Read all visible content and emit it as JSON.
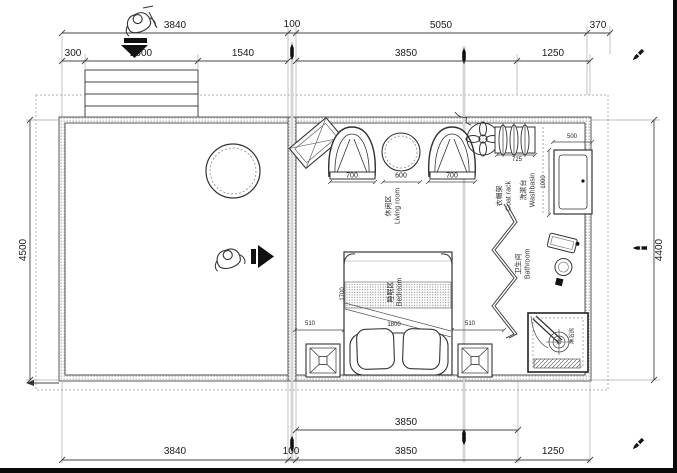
{
  "dims": {
    "top_row1": [
      "3840",
      "100",
      "5050",
      "370"
    ],
    "top_row2": [
      "300",
      "2000",
      "1540",
      "3850",
      "1250"
    ],
    "bottom_row1": [
      "3850"
    ],
    "bottom_row2": [
      "3840",
      "100",
      "3850",
      "1250"
    ],
    "left": "4500",
    "right": "4400",
    "living": [
      "700",
      "600",
      "700"
    ],
    "coat_rack": "725",
    "washbasin": [
      "500",
      "1000"
    ],
    "bed": [
      "510",
      "1800",
      "510",
      "1700"
    ]
  },
  "rooms": {
    "living": {
      "zh": "休闲区",
      "en": "Living room"
    },
    "coat_rack": {
      "zh": "衣帽架",
      "en": "Coat rack"
    },
    "washbasin": {
      "zh": "洗漱台",
      "en": "Washbasin"
    },
    "bathroom": {
      "zh": "卫生间",
      "en": "Bathroom"
    },
    "bedroom": {
      "zh": "睡眠区",
      "en": "Bedroom"
    },
    "shower": {
      "zh": "淋浴房"
    }
  },
  "icons": {
    "entry_top": "person-cart-icon",
    "entry_middle": "person-icon",
    "markers": "pencil-icon"
  },
  "colors": {
    "line": "#3c3c3c",
    "dim_text": "#1a1a1a",
    "background": "#ffffff"
  }
}
